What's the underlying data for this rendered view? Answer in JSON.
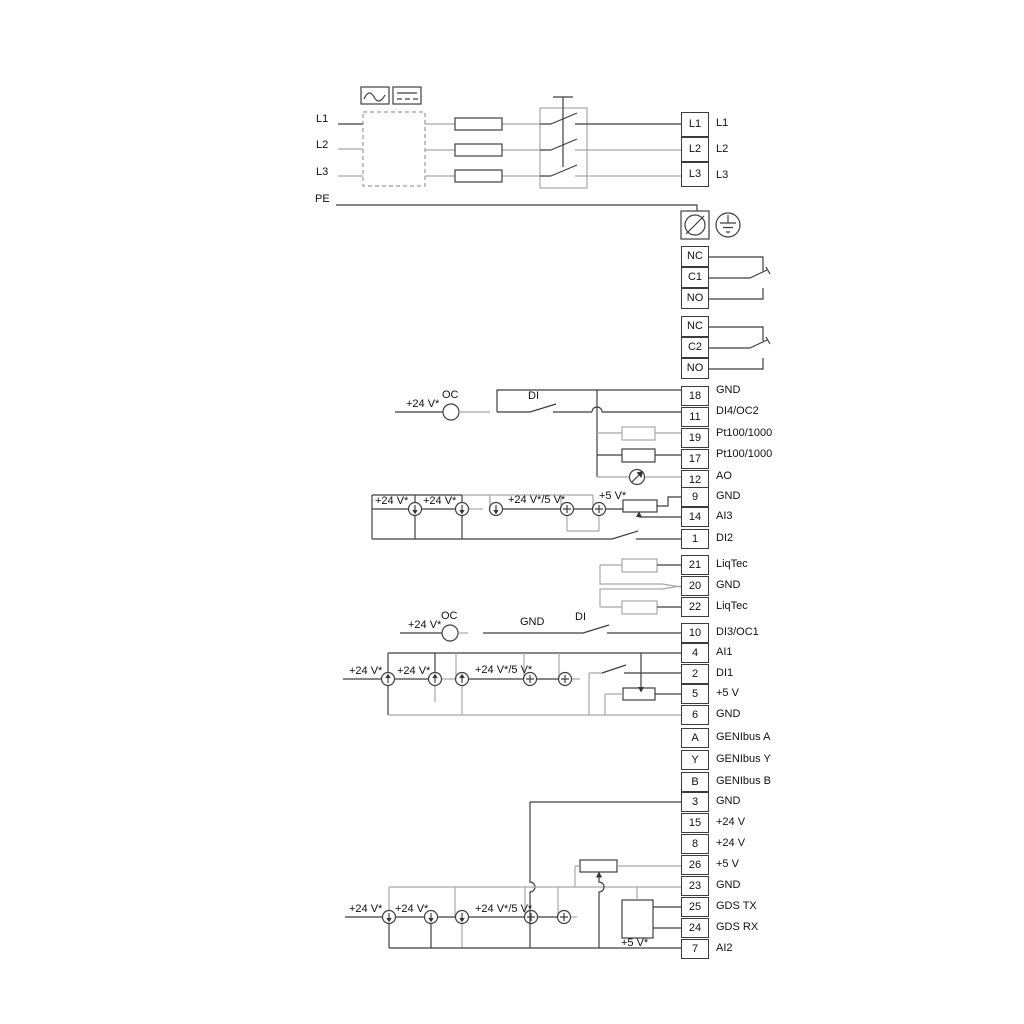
{
  "colors": {
    "line": "#3f3f3f",
    "line_gray": "#a8a8a8",
    "text": "#111111",
    "background": "#ffffff"
  },
  "power_input": {
    "labels": [
      "L1",
      "L2",
      "L3",
      "PE"
    ]
  },
  "converter": {
    "ac_icon": "ac-sine-icon",
    "dc_icon": "dc-line-icon"
  },
  "blocks": {
    "mains_out": {
      "rows": [
        "L1",
        "L2",
        "L3"
      ]
    },
    "relay1": {
      "rows": [
        "NC",
        "C1",
        "NO"
      ]
    },
    "relay2": {
      "rows": [
        "NC",
        "C2",
        "NO"
      ]
    },
    "io1": {
      "rows": [
        {
          "num": "18",
          "label": "GND"
        },
        {
          "num": "11",
          "label": "DI4/OC2"
        },
        {
          "num": "19",
          "label": "Pt100/1000"
        },
        {
          "num": "17",
          "label": "Pt100/1000"
        },
        {
          "num": "12",
          "label": "AO"
        }
      ]
    },
    "io2": {
      "rows": [
        {
          "num": "9",
          "label": "GND"
        },
        {
          "num": "14",
          "label": "AI3"
        },
        {
          "num": "1",
          "label": "DI2"
        }
      ]
    },
    "liqtec": {
      "rows": [
        {
          "num": "21",
          "label": "LiqTec"
        },
        {
          "num": "20",
          "label": "GND"
        },
        {
          "num": "22",
          "label": "LiqTec"
        }
      ]
    },
    "io3": {
      "rows": [
        {
          "num": "10",
          "label": "DI3/OC1"
        }
      ]
    },
    "io4": {
      "rows": [
        {
          "num": "4",
          "label": "AI1"
        },
        {
          "num": "2",
          "label": "DI1"
        },
        {
          "num": "5",
          "label": "+5 V"
        },
        {
          "num": "6",
          "label": "GND"
        }
      ]
    },
    "genibus": {
      "rows": [
        {
          "num": "A",
          "label": "GENIbus A"
        },
        {
          "num": "Y",
          "label": "GENIbus Y"
        },
        {
          "num": "B",
          "label": "GENIbus B"
        }
      ]
    },
    "io5": {
      "rows": [
        {
          "num": "3",
          "label": "GND"
        },
        {
          "num": "15",
          "label": "+24 V"
        },
        {
          "num": "8",
          "label": "+24 V"
        },
        {
          "num": "26",
          "label": "+5 V"
        },
        {
          "num": "23",
          "label": "GND"
        },
        {
          "num": "25",
          "label": "GDS TX"
        },
        {
          "num": "24",
          "label": "GDS RX"
        },
        {
          "num": "7",
          "label": "AI2"
        }
      ]
    }
  },
  "annotations": {
    "di4_supply": "+24 V*",
    "di4_oc": "OC",
    "di4_di": "DI",
    "ai3_24v_a": "+24 V*",
    "ai3_24v_b": "+24 V*",
    "ai3_24v5v": "+24 V*/5 V*",
    "ai3_5v": "+5 V*",
    "di3_supply": "+24 V*",
    "di3_oc": "OC",
    "di3_gnd": "GND",
    "di3_di": "DI",
    "ai1_24v_a": "+24 V*",
    "ai1_24v_b": "+24 V*",
    "ai1_24v5v": "+24 V*/5 V*",
    "ai2_24v_a": "+24 V*",
    "ai2_24v_b": "+24 V*",
    "ai2_24v5v": "+24 V*/5 V*",
    "ai2_5v": "+5 V*"
  }
}
